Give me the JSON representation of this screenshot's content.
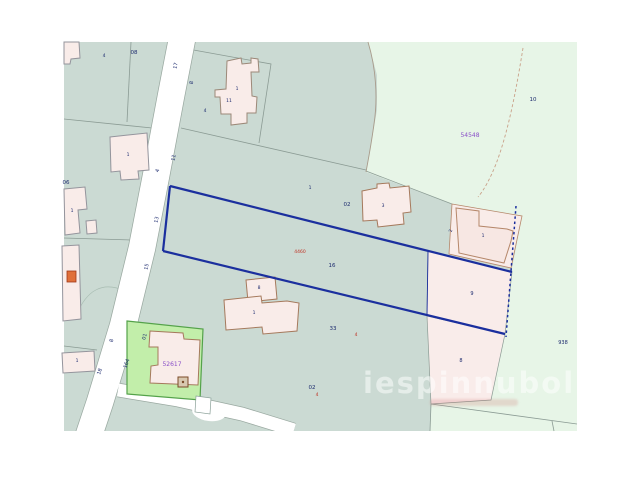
{
  "map": {
    "type": "cadastral-parcel-map",
    "watermark": "iespinnubol",
    "subject_parcel_number": "16",
    "colors": {
      "parcel_base_teal": "#cbdad3",
      "parcel_light_green": "#e7f5e7",
      "parcel_highlight_green": "#c2eeaa",
      "building_fill_pink": "#f9ece9",
      "subject_outline_blue": "#1b2f9e",
      "label_navy": "#1c2a6e",
      "label_purple": "#8a50c8",
      "label_red": "#c03224",
      "road_white": "#ffffff"
    },
    "labels": [
      {
        "text": "17",
        "x": 177,
        "y": 66,
        "cls": "navy",
        "rot": -78
      },
      {
        "text": "8",
        "x": 193,
        "y": 83,
        "cls": "navy",
        "rot": -78
      },
      {
        "text": "11",
        "x": 175,
        "y": 158,
        "cls": "navy",
        "rot": -78
      },
      {
        "text": "4",
        "x": 159,
        "y": 171,
        "cls": "navy",
        "rot": -78
      },
      {
        "text": "13",
        "x": 158,
        "y": 220,
        "cls": "navy",
        "rot": -78
      },
      {
        "text": "15",
        "x": 148,
        "y": 267,
        "cls": "navy",
        "rot": -78
      },
      {
        "text": "8",
        "x": 113,
        "y": 341,
        "cls": "navy",
        "rot": -75
      },
      {
        "text": "164",
        "x": 128,
        "y": 364,
        "cls": "navy",
        "rot": -72
      },
      {
        "text": "18",
        "x": 101,
        "y": 372,
        "cls": "navy",
        "rot": -72
      },
      {
        "text": "01",
        "x": 146,
        "y": 337,
        "cls": "navy",
        "rot": -75
      },
      {
        "text": "08",
        "x": 134,
        "y": 54,
        "cls": "navy",
        "size": 5.5
      },
      {
        "text": "06",
        "x": 66,
        "y": 184,
        "cls": "navy",
        "size": 5.5
      },
      {
        "text": "10",
        "x": 533,
        "y": 101,
        "cls": "navy",
        "size": 5.5
      },
      {
        "text": "02",
        "x": 347,
        "y": 206,
        "cls": "navy",
        "size": 5.5
      },
      {
        "text": "16",
        "x": 332,
        "y": 267,
        "cls": "navy",
        "size": 5.5
      },
      {
        "text": "33",
        "x": 333,
        "y": 330,
        "cls": "navy",
        "size": 5.5
      },
      {
        "text": "02",
        "x": 312,
        "y": 389,
        "cls": "navy",
        "size": 5.5
      },
      {
        "text": "938",
        "x": 563,
        "y": 344,
        "cls": "navy",
        "size": 5
      },
      {
        "text": "9",
        "x": 472,
        "y": 295,
        "cls": "navy",
        "size": 5
      },
      {
        "text": "8",
        "x": 461,
        "y": 362,
        "cls": "navy",
        "size": 5
      },
      {
        "text": "1",
        "x": 237,
        "y": 90,
        "cls": "navy",
        "size": 4.5
      },
      {
        "text": "11",
        "x": 229,
        "y": 102,
        "cls": "navy",
        "size": 4.5
      },
      {
        "text": "4",
        "x": 205,
        "y": 112,
        "cls": "navy",
        "size": 4.5
      },
      {
        "text": "4",
        "x": 104,
        "y": 57,
        "cls": "navy",
        "size": 4.5
      },
      {
        "text": "1",
        "x": 128,
        "y": 156,
        "cls": "navy",
        "size": 4.5
      },
      {
        "text": "1",
        "x": 72,
        "y": 212,
        "cls": "navy",
        "size": 4.5
      },
      {
        "text": "1",
        "x": 77,
        "y": 362,
        "cls": "navy",
        "size": 4.5
      },
      {
        "text": "3",
        "x": 383,
        "y": 207,
        "cls": "navy",
        "size": 4.5
      },
      {
        "text": "1",
        "x": 483,
        "y": 237,
        "cls": "navy",
        "size": 4.5
      },
      {
        "text": "8",
        "x": 259,
        "y": 289,
        "cls": "navy",
        "size": 4.5
      },
      {
        "text": "1",
        "x": 254,
        "y": 314,
        "cls": "navy",
        "size": 4.5
      },
      {
        "text": "1",
        "x": 310,
        "y": 189,
        "cls": "navy",
        "size": 4.5
      },
      {
        "text": "2",
        "x": 452,
        "y": 231,
        "cls": "navy",
        "size": 4.5,
        "rot": -78
      },
      {
        "text": "54548",
        "x": 470,
        "y": 137,
        "cls": "purple",
        "size": 6
      },
      {
        "text": "52617",
        "x": 172,
        "y": 366,
        "cls": "purple",
        "size": 6
      },
      {
        "text": "4460",
        "x": 300,
        "y": 253,
        "cls": "red",
        "size": 4.5
      },
      {
        "text": "4",
        "x": 356,
        "y": 336,
        "cls": "red",
        "size": 4.5
      },
      {
        "text": "4",
        "x": 317,
        "y": 396,
        "cls": "red",
        "size": 4.5
      }
    ]
  }
}
